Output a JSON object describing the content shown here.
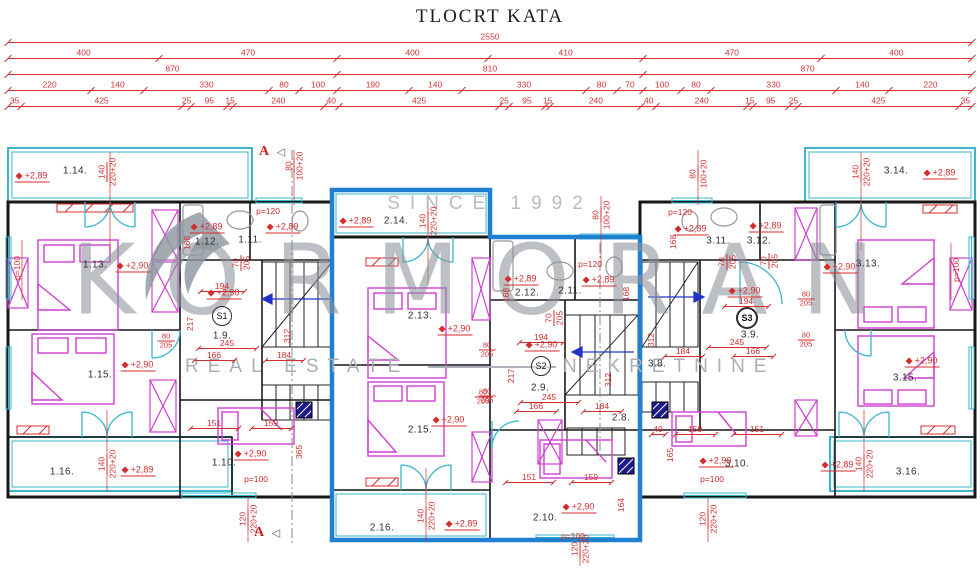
{
  "title": "TLOCRT KATA",
  "watermark": {
    "since": "SINCE 1992",
    "brand": "KORMORAN",
    "tag_left": "REAL ESTATE",
    "tag_right": "NEKRETNINE"
  },
  "colors": {
    "dim_red": "#d63434",
    "balcony_cyan": "#3ab5cd",
    "furniture_magenta": "#cf3fcf",
    "highlight_blue": "#1f7fd0",
    "wall_black": "#161616",
    "watermark_gray": "#8d949d"
  },
  "dimensions": {
    "rows": [
      {
        "y": 42,
        "values": [
          2550
        ]
      },
      {
        "y": 58,
        "values": [
          400,
          470,
          400,
          410,
          470,
          400
        ]
      },
      {
        "y": 74,
        "values": [
          870,
          810,
          870
        ]
      },
      {
        "y": 90,
        "values": [
          220,
          140,
          330,
          80,
          100,
          190,
          140,
          330,
          80,
          70,
          100,
          80,
          330,
          140,
          220
        ]
      },
      {
        "y": 106,
        "values": [
          35,
          425,
          25,
          95,
          15,
          240,
          40,
          425,
          25,
          95,
          15,
          240,
          40,
          240,
          15,
          95,
          25,
          425,
          35
        ]
      }
    ]
  },
  "plan": {
    "rooms": [
      {
        "t": "1.14.",
        "x": 75,
        "y": 171
      },
      {
        "t": "1.13.",
        "x": 95,
        "y": 265
      },
      {
        "t": "1.12.",
        "x": 207,
        "y": 242
      },
      {
        "t": "1.11.",
        "x": 250,
        "y": 240
      },
      {
        "t": "1.9.",
        "x": 222,
        "y": 336
      },
      {
        "t": "1.15.",
        "x": 100,
        "y": 375
      },
      {
        "t": "1.16.",
        "x": 62,
        "y": 472
      },
      {
        "t": "1.10.",
        "x": 224,
        "y": 463
      },
      {
        "t": "2.14.",
        "x": 396,
        "y": 221
      },
      {
        "t": "2.13.",
        "x": 420,
        "y": 316
      },
      {
        "t": "2.12.",
        "x": 527,
        "y": 293
      },
      {
        "t": "2.11.",
        "x": 570,
        "y": 291
      },
      {
        "t": "2.9.",
        "x": 540,
        "y": 388
      },
      {
        "t": "2.8.",
        "x": 621,
        "y": 418
      },
      {
        "t": "2.15.",
        "x": 420,
        "y": 430
      },
      {
        "t": "2.16.",
        "x": 382,
        "y": 528
      },
      {
        "t": "2.10.",
        "x": 545,
        "y": 518
      },
      {
        "t": "3.14.",
        "x": 896,
        "y": 171
      },
      {
        "t": "3.13.",
        "x": 868,
        "y": 264
      },
      {
        "t": "3.11.",
        "x": 718,
        "y": 241
      },
      {
        "t": "3.12.",
        "x": 759,
        "y": 241
      },
      {
        "t": "3.9.",
        "x": 750,
        "y": 335
      },
      {
        "t": "3.8.",
        "x": 657,
        "y": 364
      },
      {
        "t": "3.15.",
        "x": 905,
        "y": 378
      },
      {
        "t": "3.16.",
        "x": 908,
        "y": 472
      },
      {
        "t": "3.10.",
        "x": 737,
        "y": 464
      }
    ],
    "badges": [
      {
        "t": "S1",
        "x": 222,
        "y": 316,
        "bold": false
      },
      {
        "t": "S2",
        "x": 541,
        "y": 366,
        "bold": false
      },
      {
        "t": "S3",
        "x": 747,
        "y": 318,
        "bold": true
      }
    ],
    "levels": [
      {
        "t": "+2,89",
        "x": 32,
        "y": 177
      },
      {
        "t": "+2,89",
        "x": 207,
        "y": 228
      },
      {
        "t": "+2,89",
        "x": 283,
        "y": 228
      },
      {
        "t": "+2,90",
        "x": 133,
        "y": 267
      },
      {
        "t": "+2,90",
        "x": 224,
        "y": 294
      },
      {
        "t": "+2,90",
        "x": 138,
        "y": 366
      },
      {
        "t": "+2,89",
        "x": 138,
        "y": 471
      },
      {
        "t": "+2,90",
        "x": 251,
        "y": 455
      },
      {
        "t": "+2,89",
        "x": 356,
        "y": 222
      },
      {
        "t": "+2,89",
        "x": 521,
        "y": 280
      },
      {
        "t": "+2,89",
        "x": 599,
        "y": 281
      },
      {
        "t": "+2,90",
        "x": 455,
        "y": 330
      },
      {
        "t": "+2,90",
        "x": 542,
        "y": 346
      },
      {
        "t": "+2,90",
        "x": 449,
        "y": 421
      },
      {
        "t": "+2,89",
        "x": 462,
        "y": 525
      },
      {
        "t": "+2,90",
        "x": 579,
        "y": 508
      },
      {
        "t": "+2,89",
        "x": 691,
        "y": 230
      },
      {
        "t": "+2,89",
        "x": 766,
        "y": 227
      },
      {
        "t": "+2,90",
        "x": 745,
        "y": 292
      },
      {
        "t": "+2,90",
        "x": 840,
        "y": 268
      },
      {
        "t": "+2,90",
        "x": 922,
        "y": 362
      },
      {
        "t": "+2,89",
        "x": 838,
        "y": 466
      },
      {
        "t": "+2,90",
        "x": 716,
        "y": 462
      },
      {
        "t": "+2,89",
        "x": 940,
        "y": 174
      }
    ],
    "dims_h": [
      {
        "t": "p=120",
        "x": 268,
        "y": 211,
        "w": 0
      },
      {
        "t": "p=120",
        "x": 590,
        "y": 264,
        "w": 0
      },
      {
        "t": "p=120",
        "x": 680,
        "y": 212,
        "w": 0
      },
      {
        "t": "p=100",
        "x": 256,
        "y": 479,
        "w": 0
      },
      {
        "t": "p=100",
        "x": 573,
        "y": 536,
        "w": 0
      },
      {
        "t": "p=100",
        "x": 712,
        "y": 479,
        "w": 0
      },
      {
        "t": "194",
        "x": 222,
        "y": 286,
        "w": 44
      },
      {
        "t": "194",
        "x": 541,
        "y": 337,
        "w": 44
      },
      {
        "t": "194",
        "x": 746,
        "y": 301,
        "w": 44
      },
      {
        "t": "245",
        "x": 227,
        "y": 343,
        "w": 58
      },
      {
        "t": "245",
        "x": 549,
        "y": 397,
        "w": 58
      },
      {
        "t": "245",
        "x": 737,
        "y": 342,
        "w": 58
      },
      {
        "t": "166",
        "x": 214,
        "y": 355,
        "w": 40
      },
      {
        "t": "166",
        "x": 536,
        "y": 406,
        "w": 40
      },
      {
        "t": "166",
        "x": 753,
        "y": 351,
        "w": 40
      },
      {
        "t": "184",
        "x": 284,
        "y": 355,
        "w": 38
      },
      {
        "t": "184",
        "x": 602,
        "y": 406,
        "w": 38
      },
      {
        "t": "184",
        "x": 683,
        "y": 351,
        "w": 38
      },
      {
        "t": "151",
        "x": 214,
        "y": 423,
        "w": 48
      },
      {
        "t": "151",
        "x": 529,
        "y": 477,
        "w": 48
      },
      {
        "t": "151",
        "x": 757,
        "y": 429,
        "w": 48
      },
      {
        "t": "159",
        "x": 271,
        "y": 423,
        "w": 40
      },
      {
        "t": "159",
        "x": 591,
        "y": 477,
        "w": 40
      },
      {
        "t": "159",
        "x": 695,
        "y": 429,
        "w": 40
      },
      {
        "t": "40",
        "x": 658,
        "y": 429,
        "w": 14
      }
    ],
    "fracs": [
      {
        "a": "80",
        "b": "205",
        "x": 166,
        "y": 341
      },
      {
        "a": "80",
        "b": "205",
        "x": 483,
        "y": 397
      },
      {
        "a": "80",
        "b": "205",
        "x": 806,
        "y": 299
      },
      {
        "a": "80",
        "b": "205",
        "x": 806,
        "y": 340
      },
      {
        "a": "80",
        "b": "205",
        "x": 487,
        "y": 350
      },
      {
        "a": "80",
        "b": "205",
        "x": 487,
        "y": 396
      }
    ],
    "dims_v": [
      {
        "a": "140",
        "b": "220+20",
        "x": 107,
        "y": 172
      },
      {
        "a": "140",
        "b": "220+20",
        "x": 428,
        "y": 221
      },
      {
        "a": "140",
        "b": "220+20",
        "x": 861,
        "y": 172
      },
      {
        "a": "140",
        "b": "220+20",
        "x": 107,
        "y": 464
      },
      {
        "a": "140",
        "b": "220+20",
        "x": 426,
        "y": 516
      },
      {
        "a": "140",
        "b": "220+20",
        "x": 864,
        "y": 464
      },
      {
        "a": "80",
        "b": "100+20",
        "x": 294,
        "y": 166
      },
      {
        "a": "80",
        "b": "100+20",
        "x": 601,
        "y": 215
      },
      {
        "a": "80",
        "b": "100+20",
        "x": 698,
        "y": 174
      },
      {
        "a": "120",
        "b": "220+20",
        "x": 248,
        "y": 519
      },
      {
        "a": "120",
        "b": "220+20",
        "x": 580,
        "y": 549
      },
      {
        "a": "120",
        "b": "220+20",
        "x": 708,
        "y": 519
      },
      {
        "a": "70",
        "b": "205",
        "x": 241,
        "y": 263
      },
      {
        "a": "70",
        "b": "205",
        "x": 554,
        "y": 318
      },
      {
        "a": "70",
        "b": "205",
        "x": 727,
        "y": 262
      },
      {
        "a": "70",
        "b": "205",
        "x": 769,
        "y": 261
      },
      {
        "a": "168",
        "b": "",
        "x": 187,
        "y": 243
      },
      {
        "a": "168",
        "b": "",
        "x": 506,
        "y": 295
      },
      {
        "a": "168",
        "b": "",
        "x": 626,
        "y": 294
      },
      {
        "a": "168",
        "b": "",
        "x": 673,
        "y": 242
      },
      {
        "a": "312",
        "b": "",
        "x": 287,
        "y": 336
      },
      {
        "a": "312",
        "b": "",
        "x": 608,
        "y": 380
      },
      {
        "a": "312",
        "b": "",
        "x": 651,
        "y": 340
      },
      {
        "a": "217",
        "b": "",
        "x": 190,
        "y": 324
      },
      {
        "a": "217",
        "b": "",
        "x": 511,
        "y": 376
      },
      {
        "a": "365",
        "b": "",
        "x": 299,
        "y": 452
      },
      {
        "a": "164",
        "b": "",
        "x": 621,
        "y": 505
      },
      {
        "a": "165",
        "b": "",
        "x": 670,
        "y": 455
      },
      {
        "a": "p=100",
        "b": "",
        "x": 17,
        "y": 268
      },
      {
        "a": "p=100",
        "b": "",
        "x": 956,
        "y": 270
      }
    ],
    "sections": [
      {
        "t": "A",
        "x": 264,
        "y": 152,
        "arrow": "◁"
      },
      {
        "t": "A",
        "x": 259,
        "y": 533,
        "arrow": "◁"
      }
    ]
  }
}
